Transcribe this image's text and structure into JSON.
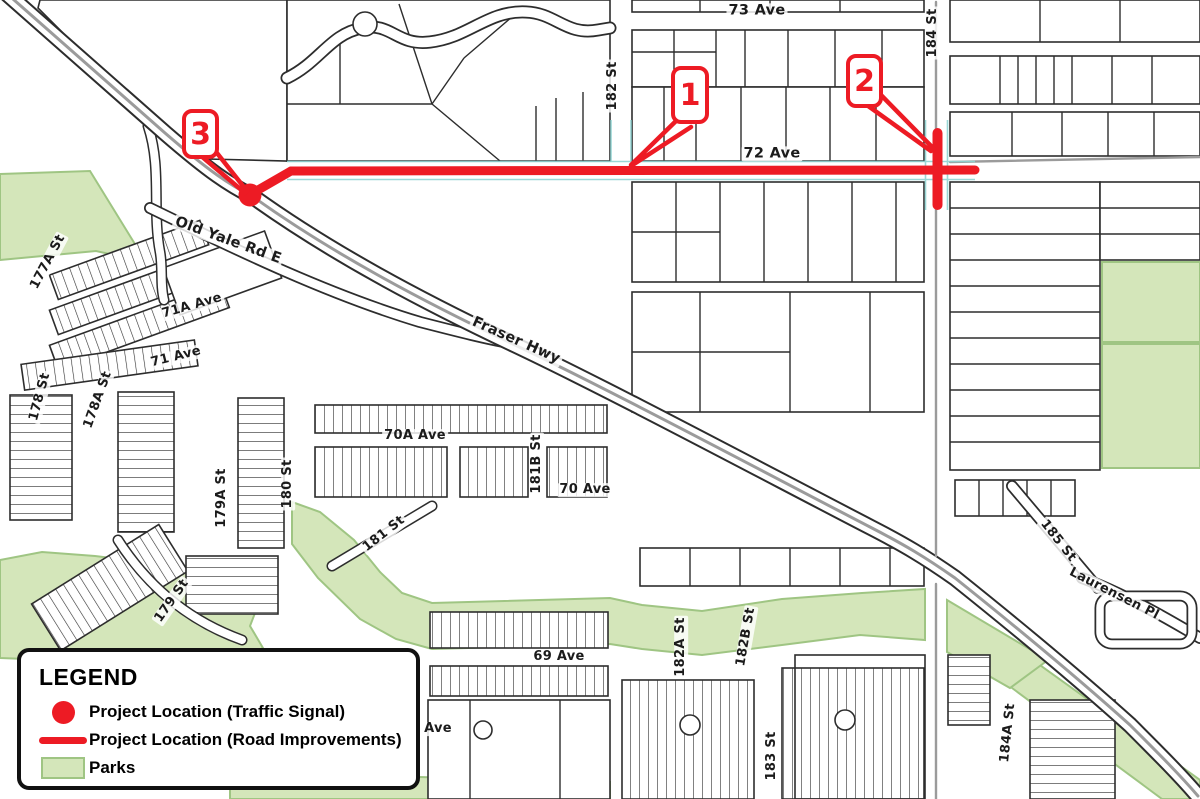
{
  "colors": {
    "red": "#ed1b24",
    "park": "#d4e6ba",
    "park_border": "#9fc583",
    "line": "#2d2d2d",
    "road_gray": "#9b9b9b",
    "teal": "#8fd3d1",
    "label": "#1b1b1b"
  },
  "streets": {
    "labels": [
      {
        "text": "73 Ave"
      },
      {
        "text": "182 St"
      },
      {
        "text": "184 St"
      },
      {
        "text": "72 Ave"
      },
      {
        "text": "Old Yale Rd E"
      },
      {
        "text": "177A St"
      },
      {
        "text": "71A Ave"
      },
      {
        "text": "71 Ave"
      },
      {
        "text": "178 St"
      },
      {
        "text": "178A St"
      },
      {
        "text": "Fraser Hwy"
      },
      {
        "text": "70A Ave"
      },
      {
        "text": "181B St"
      },
      {
        "text": "70 Ave"
      },
      {
        "text": "180 St"
      },
      {
        "text": "179A St"
      },
      {
        "text": "181 St"
      },
      {
        "text": "179 St"
      },
      {
        "text": "69 Ave"
      },
      {
        "text": "182A St"
      },
      {
        "text": "182B St"
      },
      {
        "text": "183 St"
      },
      {
        "text": "184A St"
      },
      {
        "text": "185 St"
      },
      {
        "text": "Laurensen Pl"
      },
      {
        "text": "Ave"
      }
    ]
  },
  "callouts": [
    {
      "number": "1"
    },
    {
      "number": "2"
    },
    {
      "number": "3"
    }
  ],
  "legend": {
    "title": "LEGEND",
    "items": [
      {
        "label": "Project Location (Traffic Signal)"
      },
      {
        "label": "Project Location (Road Improvements)"
      },
      {
        "label": "Parks"
      }
    ]
  }
}
